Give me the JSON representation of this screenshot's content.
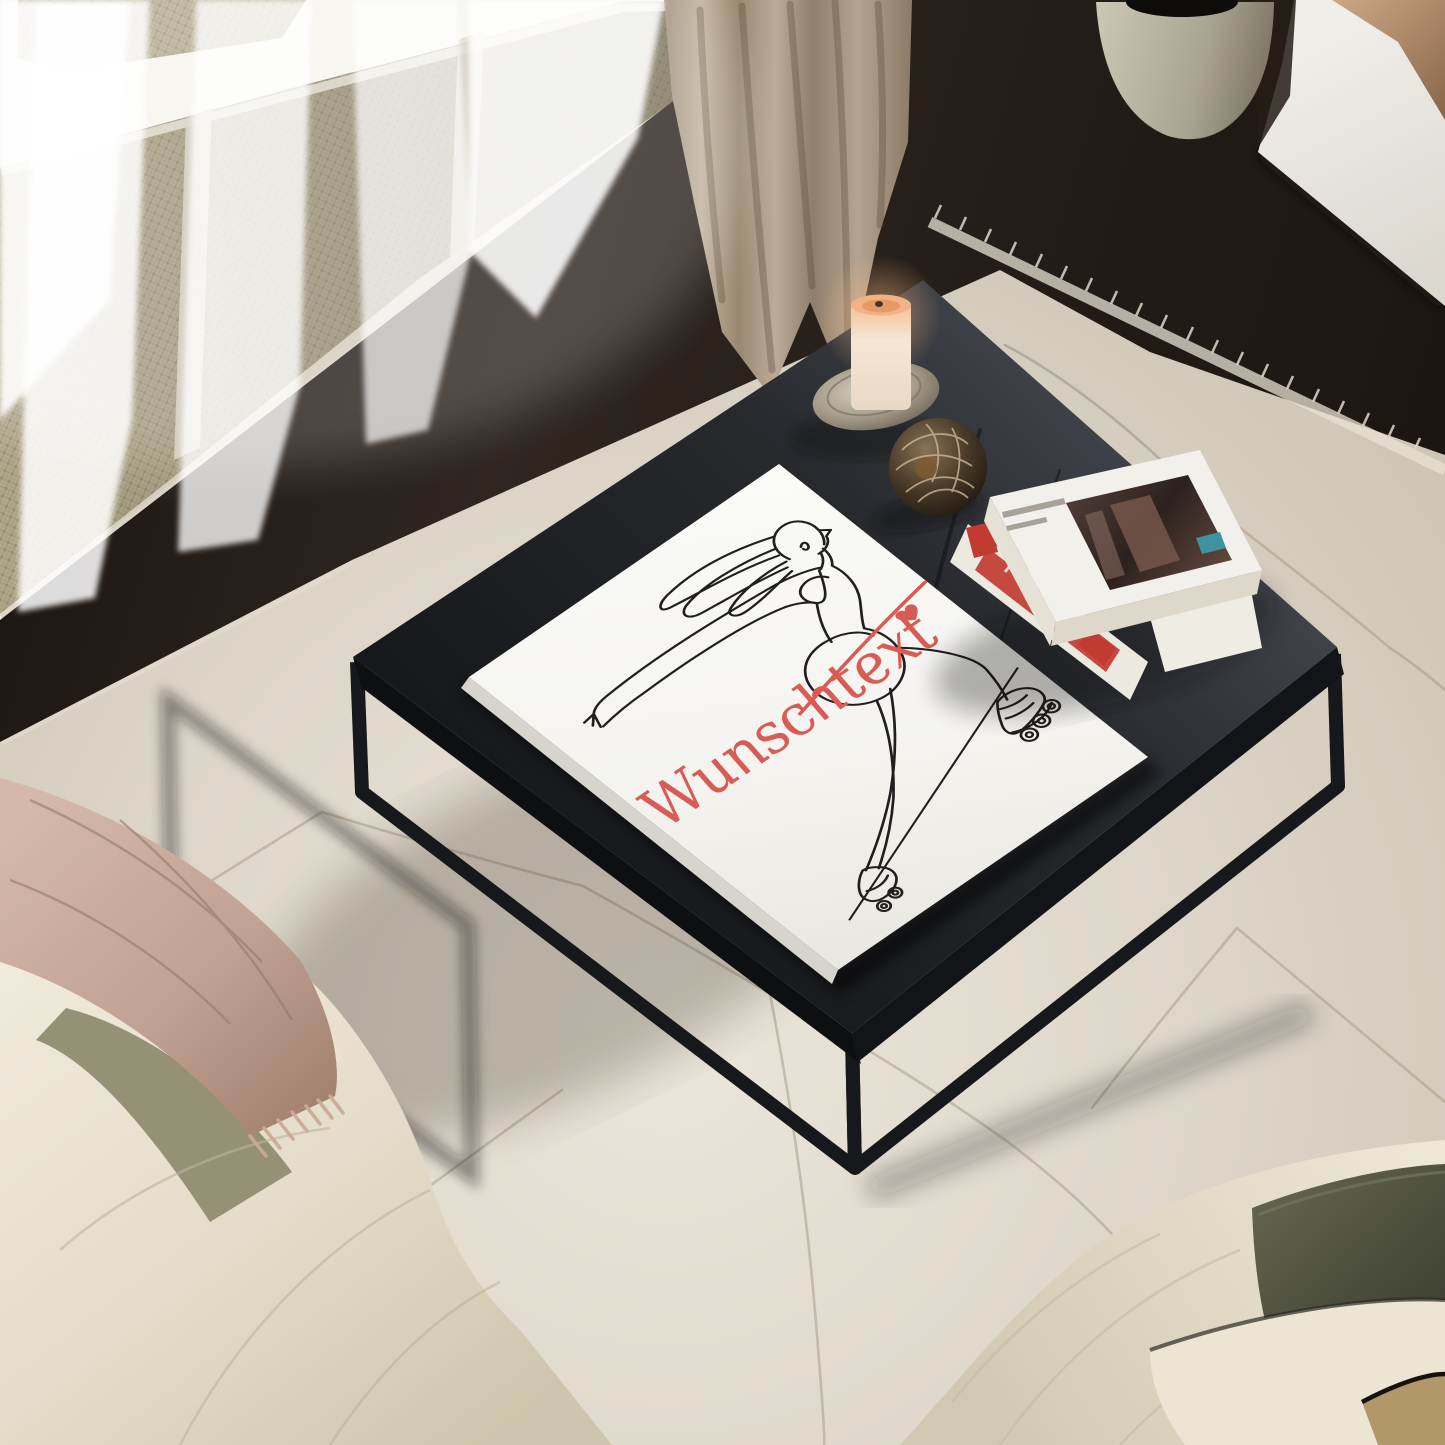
{
  "artwork": {
    "custom_text": "Wunschtext",
    "accent_color": "#d85b54"
  },
  "palette": {
    "rug": "#dcd5c8",
    "floor_wood": "#2a221c",
    "table_top": "#2e3034",
    "canvas_white": "#f6f5f2",
    "line_art": "#201e1e",
    "curtain_linen": "#b3a290",
    "radiator_cane": "#b1a78a",
    "sofa_cream": "#e9e2d2",
    "throw_blush": "#c3a396",
    "pillow_olive": "#565847",
    "pillow_tan": "#b1976a",
    "book_red": "#c23b31",
    "book_teal": "#3e93a0",
    "candle_wax": "#f3e2d0",
    "candle_glow": "#f2b283"
  }
}
